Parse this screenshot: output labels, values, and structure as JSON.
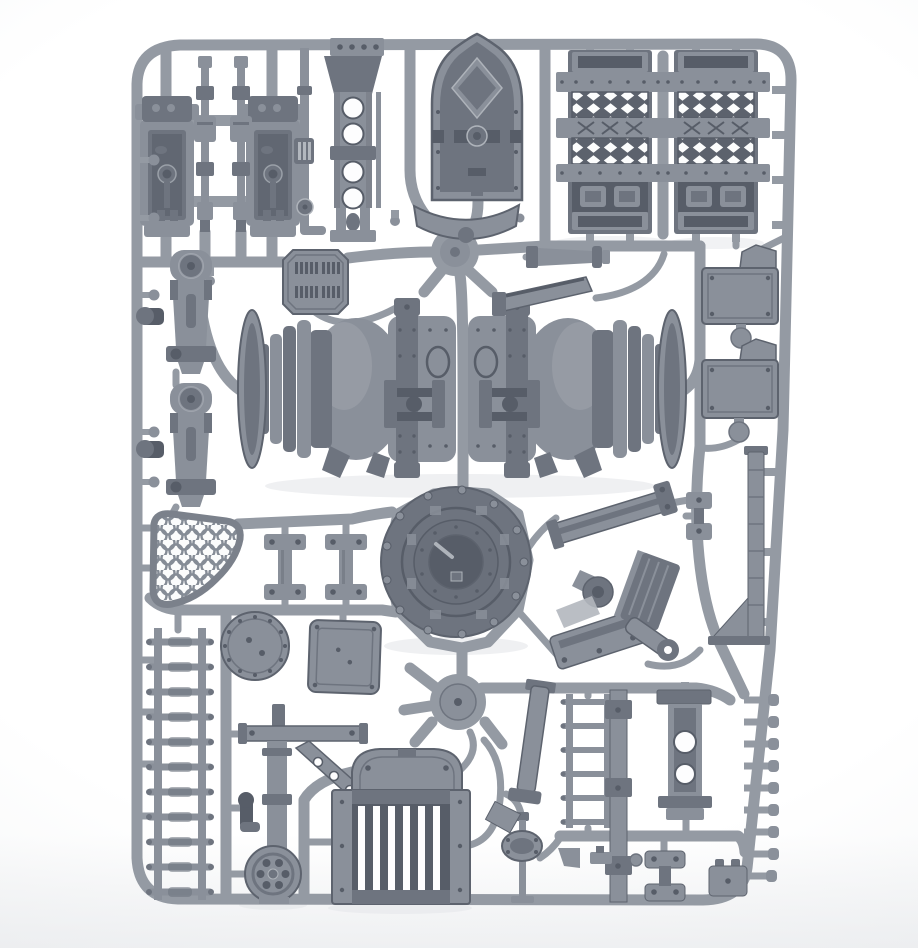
{
  "image": {
    "subject": "Grey injection-moulded plastic model kit sprue with industrial terrain parts, photographed on a white studio background",
    "medium": "product photograph",
    "orientation": "portrait",
    "width_px": 918,
    "height_px": 948,
    "visible_text": "none"
  },
  "palette": {
    "background": "#ffffff",
    "background_edge": "#eef0f2",
    "runner": "#949aa3",
    "runner_dark": "#7b818b",
    "part_light": "#b2b7be",
    "part_mid": "#8a909a",
    "part_dark": "#6e747f",
    "part_deep": "#575d68",
    "hole": "#fdfdfe",
    "shadow": "#e4e6e9",
    "outline": "#5d636e"
  },
  "sprue": {
    "frame": {
      "shape": "rounded rectangle runner frame",
      "approx_bounds": [
        137,
        44,
        654,
        856
      ]
    },
    "junction_hubs": [
      {
        "name": "upper-hub",
        "center": [
          455,
          252
        ],
        "radius": 24
      },
      {
        "name": "lower-hub",
        "center": [
          458,
          702
        ],
        "radius": 28
      }
    ],
    "parts": [
      {
        "name": "tool-trough-1",
        "description": "open rectangular trough with hinged bolted top block and piston detail inside",
        "approx_box": [
          140,
          96,
          54,
          146
        ]
      },
      {
        "name": "tool-trough-2",
        "description": "open rectangular trough with hinged bolted top block and piston detail inside",
        "approx_box": [
          246,
          96,
          54,
          146
        ]
      },
      {
        "name": "segmented-pipe-1",
        "description": "vertical segmented pipe column with collars",
        "approx_box": [
          194,
          56,
          22,
          176
        ]
      },
      {
        "name": "segmented-pipe-2",
        "description": "vertical segmented pipe column with collars",
        "approx_box": [
          230,
          56,
          22,
          176
        ]
      },
      {
        "name": "support-column",
        "description": "girder column with flared bolted top plate and four round lightening holes",
        "approx_box": [
          316,
          36,
          70,
          206
        ]
      },
      {
        "name": "thin-pipe-with-valve",
        "description": "thin pipe run with ribbed box and small valve wheel elbow",
        "approx_box": [
          294,
          46,
          32,
          198
        ]
      },
      {
        "name": "gothic-door",
        "description": "pointed-arch armoured door with diamond plaque, cross pipe and central valve",
        "approx_box": [
          432,
          34,
          90,
          166
        ]
      },
      {
        "name": "yoke-bracket",
        "description": "wide curved yoke bracket",
        "approx_box": [
          413,
          204,
          107,
          44
        ]
      },
      {
        "name": "mesh-walkway-panel-1",
        "description": "riveted panel with two diamond-mesh bands, X-braced band and side lugs",
        "approx_box": [
          568,
          50,
          84,
          184
        ]
      },
      {
        "name": "mesh-walkway-panel-2",
        "description": "riveted panel with two diamond-mesh bands, X-braced band and side lugs",
        "approx_box": [
          674,
          50,
          84,
          184
        ]
      },
      {
        "name": "tapered-nozzle",
        "description": "small horizontal tapered nozzle with flange",
        "approx_box": [
          526,
          243,
          84,
          26
        ]
      },
      {
        "name": "octagon-vent-plate",
        "description": "octagonal plate with four clusters of vent slits",
        "approx_box": [
          283,
          250,
          65,
          64
        ]
      },
      {
        "name": "pipe-hanger-bracket-1",
        "description": "hanger bracket with clevis wheel, slotted body and side cylinder",
        "approx_box": [
          140,
          250,
          74,
          124
        ]
      },
      {
        "name": "pipe-hanger-bracket-2",
        "description": "hanger bracket with clevis wheel, slotted body and side cylinder",
        "approx_box": [
          140,
          383,
          74,
          124
        ]
      },
      {
        "name": "plasma-tank-half-left",
        "description": "domed riveted boiler half with ribbed coupling, clamp band and support legs",
        "approx_box": [
          238,
          300,
          224,
          178
        ]
      },
      {
        "name": "plasma-tank-half-right",
        "description": "mirrored domed riveted boiler half with ribbed coupling and clamp band",
        "approx_box": [
          462,
          300,
          224,
          178
        ]
      },
      {
        "name": "support-arm",
        "description": "angled flat support arm with clevis end",
        "approx_box": [
          494,
          276,
          104,
          40
        ]
      },
      {
        "name": "equipment-box-1",
        "description": "rectangular riveted equipment box with angled bracket and round tab",
        "approx_box": [
          702,
          245,
          76,
          103
        ]
      },
      {
        "name": "equipment-box-2",
        "description": "rectangular riveted equipment box with angled bracket and round tab",
        "approx_box": [
          702,
          339,
          76,
          103
        ]
      },
      {
        "name": "turbine-dome-hatch",
        "description": "large circular domed hatch with bolted rim, clipped inner ring and handled center hatch",
        "center": [
          456,
          562
        ],
        "radius": 75
      },
      {
        "name": "scale-mesh-shield",
        "description": "shield-shaped grille filled with fish-scale mesh",
        "approx_box": [
          150,
          512,
          92,
          96
        ]
      },
      {
        "name": "beam-clamp-1",
        "description": "I-shaped clamp with bolted end plates",
        "approx_box": [
          264,
          534,
          42,
          66
        ]
      },
      {
        "name": "beam-clamp-2",
        "description": "I-shaped clamp with bolted end plates",
        "approx_box": [
          325,
          534,
          42,
          66
        ]
      },
      {
        "name": "round-access-hatch",
        "description": "circular riveted hatch disc",
        "center": [
          255,
          646
        ],
        "radius": 34
      },
      {
        "name": "square-access-hatch",
        "description": "square riveted hatch plate",
        "approx_box": [
          309,
          621,
          71,
          72
        ]
      },
      {
        "name": "ladder-long",
        "description": "long ladder with eleven capped rungs",
        "approx_box": [
          148,
          628,
          62,
          272
        ]
      },
      {
        "name": "crane-hoist-assembly",
        "description": "post and beam hoist with drilled diagonal strut, elbow pipe and spoked pulley wheel",
        "approx_box": [
          226,
          704,
          150,
          200
        ]
      },
      {
        "name": "louvred-grille",
        "description": "barred radiator grille with arched cap plate and bolted side columns",
        "approx_box": [
          332,
          746,
          138,
          158
        ]
      },
      {
        "name": "tapered-girder-beam",
        "description": "angled channel girder with clevis end plates",
        "approx_box": [
          545,
          488,
          135,
          58
        ]
      },
      {
        "name": "servo-turret-assembly",
        "description": "ribbed sled base, round boss bracket, slotted arm with clevis and grooved plate stack",
        "approx_box": [
          556,
          556,
          120,
          112
        ]
      },
      {
        "name": "small-clamp-dumbbell",
        "description": "small double-plate clamp",
        "approx_box": [
          684,
          490,
          30,
          52
        ]
      },
      {
        "name": "stanchion-post",
        "description": "ribbed stanchion post with gusset and foot plate",
        "approx_box": [
          706,
          446,
          72,
          200
        ]
      },
      {
        "name": "moulding-peg-strip",
        "description": "row of nine round-headed moulding pegs on the right runner",
        "approx_box": [
          744,
          694,
          40,
          190
        ]
      },
      {
        "name": "ladder-short",
        "description": "short ladder with six rungs",
        "approx_box": [
          562,
          692,
          50,
          138
        ]
      },
      {
        "name": "riveted-girder",
        "description": "vertical girder with three clamp blocks",
        "approx_box": [
          604,
          688,
          28,
          216
        ]
      },
      {
        "name": "drilled-channel-bracket",
        "description": "vertical channel bracket with two round holes and flanges",
        "approx_box": [
          656,
          688,
          56,
          134
        ]
      },
      {
        "name": "double-plate-clamp",
        "description": "dog-bone clamp of two bolted plates",
        "approx_box": [
          645,
          850,
          40,
          52
        ]
      },
      {
        "name": "stud-box",
        "description": "small box with two top studs",
        "approx_box": [
          709,
          858,
          38,
          38
        ]
      },
      {
        "name": "pressure-gauge-stand",
        "description": "thin stand with oval bolted gauge head",
        "approx_box": [
          506,
          812,
          40,
          92
        ]
      },
      {
        "name": "angled-support-bracket",
        "description": "angled support bracket with cap, clevis and foot",
        "approx_box": [
          497,
          678,
          52,
          158
        ]
      },
      {
        "name": "small-fittings",
        "description": "assorted tiny wedge, stud and knob fittings",
        "approx_box": [
          556,
          844,
          92,
          26
        ]
      }
    ]
  }
}
